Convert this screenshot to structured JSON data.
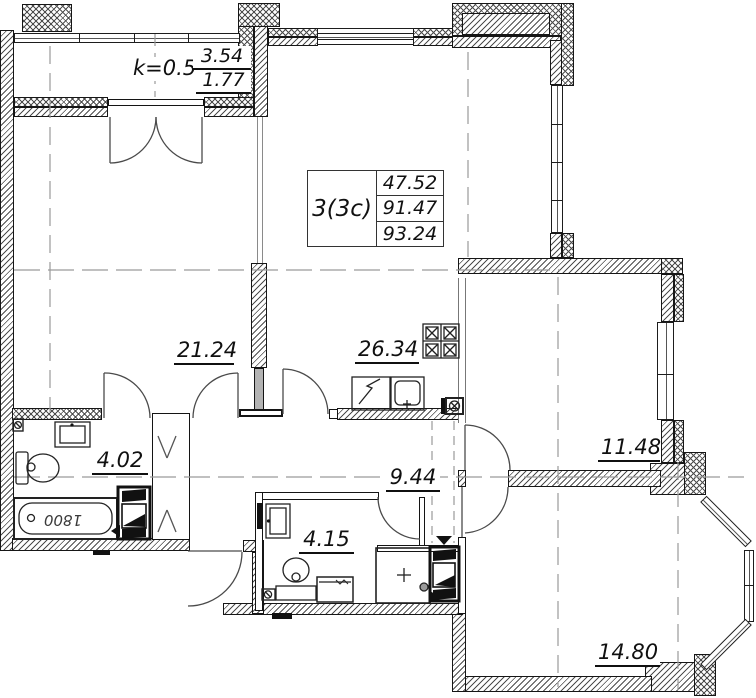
{
  "floor_plan": {
    "balcony": {
      "coefficient": "k=0.5",
      "area_total": "3.54",
      "area_counted": "1.77"
    },
    "apartment_table": {
      "type": "3(3c)",
      "living_area": "47.52",
      "floor_area": "91.47",
      "total_area": "93.24"
    },
    "room_areas": {
      "living_room": "21.24",
      "kitchen_living": "26.34",
      "bedroom_right": "11.48",
      "hallway": "9.44",
      "bathroom": "4.02",
      "bathroom_2": "4.15",
      "bedroom_bottom": "14.80"
    },
    "bathtub_length_mm": "1800"
  }
}
